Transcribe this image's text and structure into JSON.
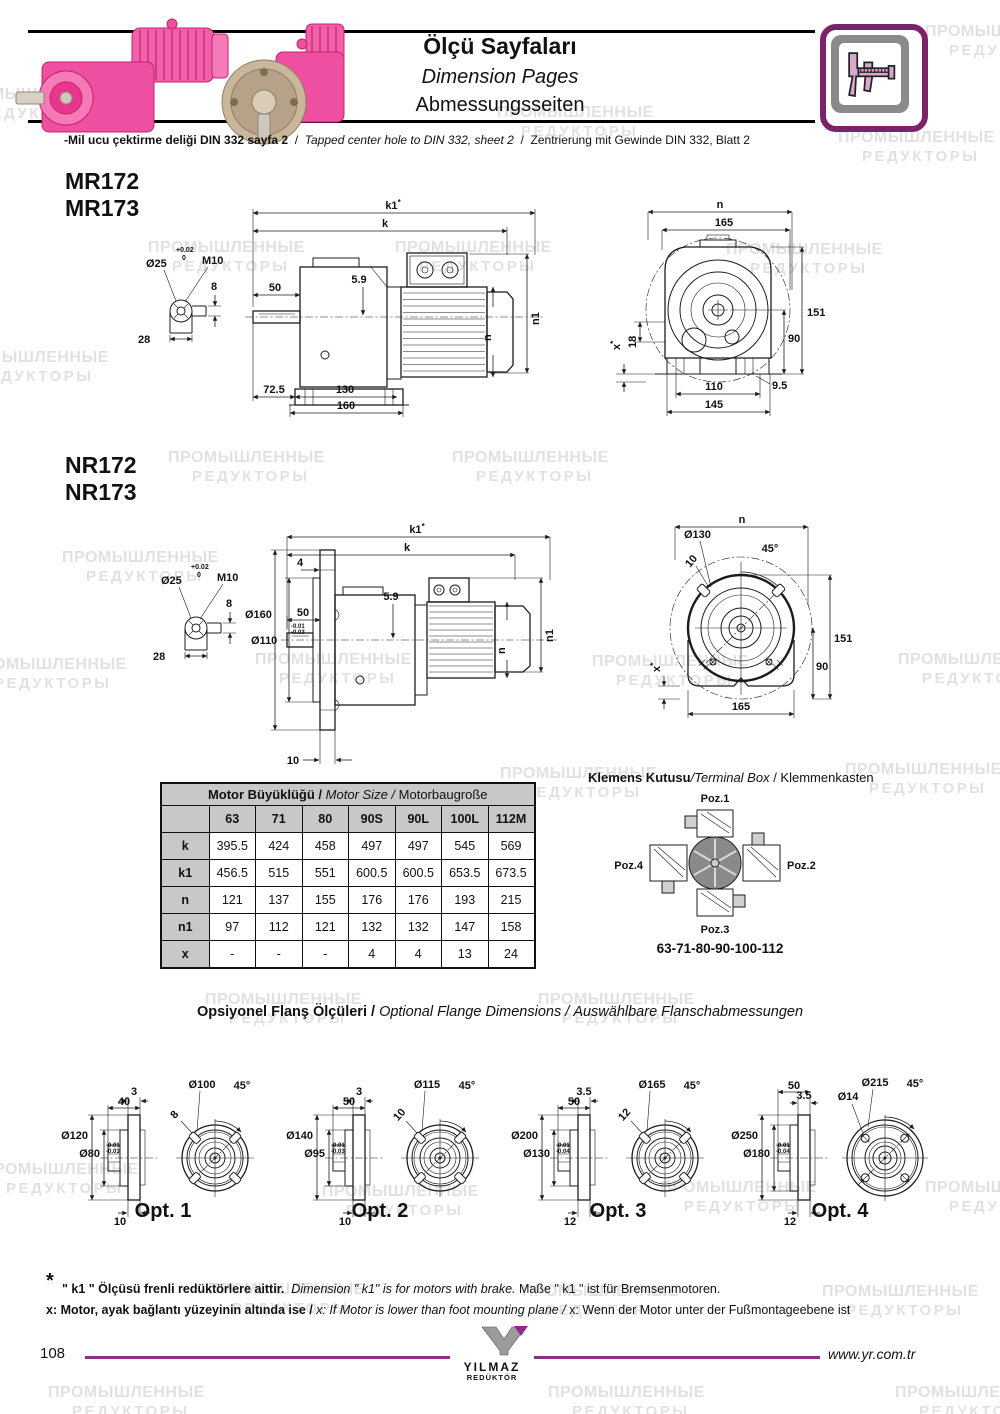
{
  "watermark": {
    "line1": "ПРОМЫШЛЕННЫЕ",
    "line2": "РЕДУКТОРЫ"
  },
  "header": {
    "title_tr": "Ölçü Sayfaları",
    "title_en": "Dimension Pages",
    "title_de": "Abmessungsseiten"
  },
  "note": {
    "tr": "-Mil ucu çektirme deliği DIN 332 sayfa 2",
    "sep1": "/",
    "en": "Tapped center hole to DIN 332, sheet 2",
    "sep2": "/",
    "de": "Zentrierung mit Gewinde DIN 332, Blatt 2"
  },
  "shaft_detail": {
    "tol_top": "+0.02",
    "tol_bottom": "0",
    "dia": "Ø25",
    "thread": "M10",
    "depth": "8",
    "width": "28"
  },
  "mr": {
    "model1": "MR172",
    "model2": "MR173",
    "side": {
      "k1": "k1",
      "star": "*",
      "k": "k",
      "d50": "50",
      "d59": "5.9",
      "n1": "n1",
      "n": "n",
      "d72_5": "72.5",
      "d130": "130",
      "d160": "160"
    },
    "rear": {
      "n": "n",
      "d165": "165",
      "d151": "151",
      "d90": "90",
      "d18": "18",
      "x": "x",
      "star": "*",
      "d9_5": "9.5",
      "d110": "110",
      "d145": "145"
    }
  },
  "nr": {
    "model1": "NR172",
    "model2": "NR173",
    "side": {
      "k1": "k1",
      "star": "*",
      "k": "k",
      "d4": "4",
      "dia160": "Ø160",
      "dia110": "Ø110",
      "tol1": "-0.01",
      "tol2": "-0.03",
      "d50": "50",
      "d59": "5.9",
      "n1": "n1",
      "n": "n",
      "d10": "10"
    },
    "rear": {
      "n": "n",
      "dia130": "Ø130",
      "d10": "10",
      "angle": "45°",
      "d151": "151",
      "d90": "90",
      "x": "x",
      "star": "*",
      "d165": "165"
    }
  },
  "table": {
    "title_tr": "Motor Büyüklüğü /",
    "title_en": "Motor Size /",
    "title_de": "Motorbaugroße",
    "cols": [
      "63",
      "71",
      "80",
      "90S",
      "90L",
      "100L",
      "112M"
    ],
    "rows": [
      {
        "label": "k",
        "values": [
          "395.5",
          "424",
          "458",
          "497",
          "497",
          "545",
          "569"
        ]
      },
      {
        "label": "k1",
        "values": [
          "456.5",
          "515",
          "551",
          "600.5",
          "600.5",
          "653.5",
          "673.5"
        ]
      },
      {
        "label": "n",
        "values": [
          "121",
          "137",
          "155",
          "176",
          "176",
          "193",
          "215"
        ]
      },
      {
        "label": "n1",
        "values": [
          "97",
          "112",
          "121",
          "132",
          "132",
          "147",
          "158"
        ]
      },
      {
        "label": "x",
        "values": [
          "-",
          "-",
          "-",
          "4",
          "4",
          "13",
          "24"
        ]
      }
    ]
  },
  "terminal_box": {
    "title_tr": "Klemens Kutusu",
    "title_en": "/Terminal Box",
    "title_de": "/ Klemmenkasten",
    "poz1": "Poz.1",
    "poz2": "Poz.2",
    "poz3": "Poz.3",
    "poz4": "Poz.4",
    "caption": "63-71-80-90-100-112"
  },
  "flange": {
    "title_tr": "Opsiyonel Flanş Ölçüleri /",
    "title_en": "Optional Flange Dimensions /",
    "title_de": "Auswählbare Flanschabmessungen",
    "options": [
      {
        "label": "Opt. 1",
        "thickness": "3",
        "hub": "40",
        "outer": "Ø120",
        "spigot": "Ø80",
        "tol1": "-0.01",
        "tol2": "-0.03",
        "bottom": "10",
        "bolt_circle": "Ø100",
        "angle": "45°",
        "slot": "8"
      },
      {
        "label": "Opt. 2",
        "thickness": "3",
        "hub": "50",
        "outer": "Ø140",
        "spigot": "Ø95",
        "tol1": "-0.01",
        "tol2": "-0.03",
        "bottom": "10",
        "bolt_circle": "Ø115",
        "angle": "45°",
        "slot": "10"
      },
      {
        "label": "Opt. 3",
        "thickness": "3.5",
        "hub": "50",
        "outer": "Ø200",
        "spigot": "Ø130",
        "tol1": "-0.01",
        "tol2": "-0.04",
        "bottom": "12",
        "bolt_circle": "Ø165",
        "angle": "45°",
        "slot": "12"
      },
      {
        "label": "Opt. 4",
        "thickness": "3.5",
        "hub": "50",
        "outer": "Ø250",
        "spigot": "Ø180",
        "tol1": "-0.01",
        "tol2": "-0.04",
        "bottom": "12",
        "bolt_circle": "Ø215",
        "angle": "45°",
        "hole": "Ø14"
      }
    ]
  },
  "footnotes": {
    "star": "*",
    "f1_tr": "\" k1 \" Ölçüsü frenli redüktörlere aittir.",
    "f1_en": "Dimension \" k1\" is for motors with brake.",
    "f1_de": "Maße \" k1 \" ist für Bremsenmotoren.",
    "f2_tr": "x: Motor, ayak bağlantı yüzeyinin altında ise /",
    "f2_en": "x: If Motor is lower than foot mounting plane /",
    "f2_de": "x: Wenn der Motor unter der Fußmontageebene ist"
  },
  "footer": {
    "page": "108",
    "site": "www.yr.com.tr",
    "logo_name": "YILMAZ",
    "logo_sub": "REDÜKTÖR"
  }
}
